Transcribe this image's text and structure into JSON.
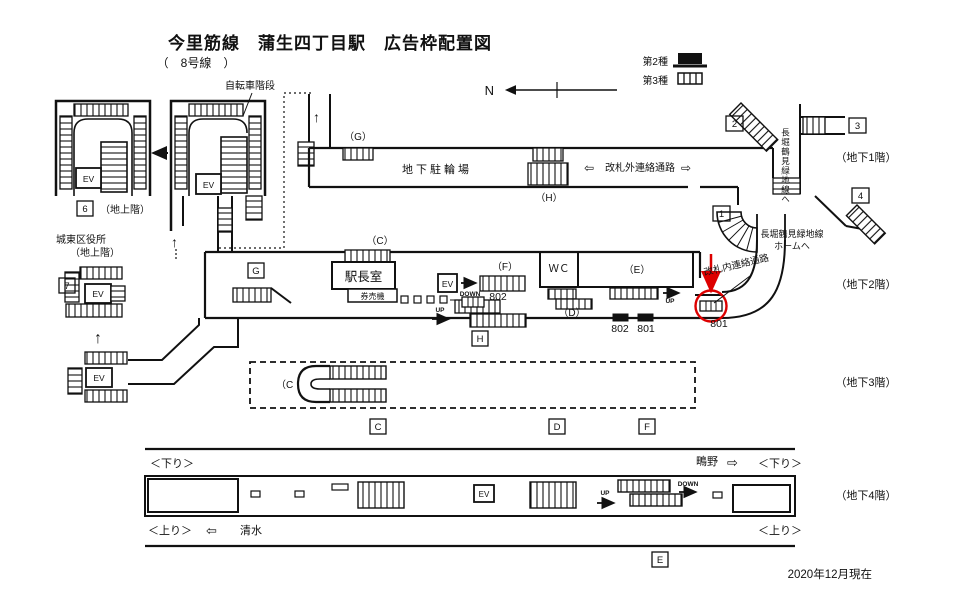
{
  "title": {
    "main": "今里筋線　蒲生四丁目駅　広告枠配置図",
    "sub": "（　8号線　）"
  },
  "legend": {
    "type2": "第2種",
    "type3": "第3種"
  },
  "compass": {
    "n": "N"
  },
  "common": {
    "ev": "EV",
    "up": "UP",
    "down": "DOWN"
  },
  "floors": {
    "b1": "（地下1階）",
    "b2": "（地下2階）",
    "b3": "（地下3階）",
    "b4": "（地下4階）"
  },
  "ground": {
    "exit6": "6",
    "exit7": "7",
    "ground_floor_label": "（地上階）",
    "bicycle_stairs": "自転車階段",
    "ward_office": "城東区役所",
    "ward_office_floor": "（地上階）"
  },
  "b1": {
    "bike_parking": "地下駐輪場",
    "outside_passage": "改札外連絡通路",
    "area_g": "（G）",
    "area_h": "（H）",
    "exit1": "1",
    "exit2": "2",
    "exit3": "3",
    "exit4": "4",
    "to_nagahori_vertical": "長堀鶴見緑地線へ",
    "to_nagahori_platform_1": "長堀鶴見緑地線",
    "to_nagahori_platform_2": "ホームへ"
  },
  "b2": {
    "area_c": "（C）",
    "area_f": "（F）",
    "area_d": "（D）",
    "area_e": "（E）",
    "box_g": "G",
    "box_h": "H",
    "station_office": "駅長室",
    "ticket_machines": "券売機",
    "wc": "ＷＣ",
    "inside_passage": "改札内連絡通路",
    "ad_802_center": "802",
    "ad_802_left": "802",
    "ad_801_mid": "801",
    "ad_801_circled": "801"
  },
  "b3": {
    "area_c": "（C",
    "box_c": "C",
    "box_d": "D",
    "box_f": "F"
  },
  "b4": {
    "down_left": "＜下り＞",
    "down_right": "＜下り＞",
    "up_left": "＜上り＞",
    "up_right": "＜上り＞",
    "shimizu": "清水",
    "shigino": "鴫野",
    "box_e": "E"
  },
  "footer": {
    "date": "2020年12月現在"
  },
  "colors": {
    "accent_red": "#dd0000",
    "ink": "#111111"
  }
}
